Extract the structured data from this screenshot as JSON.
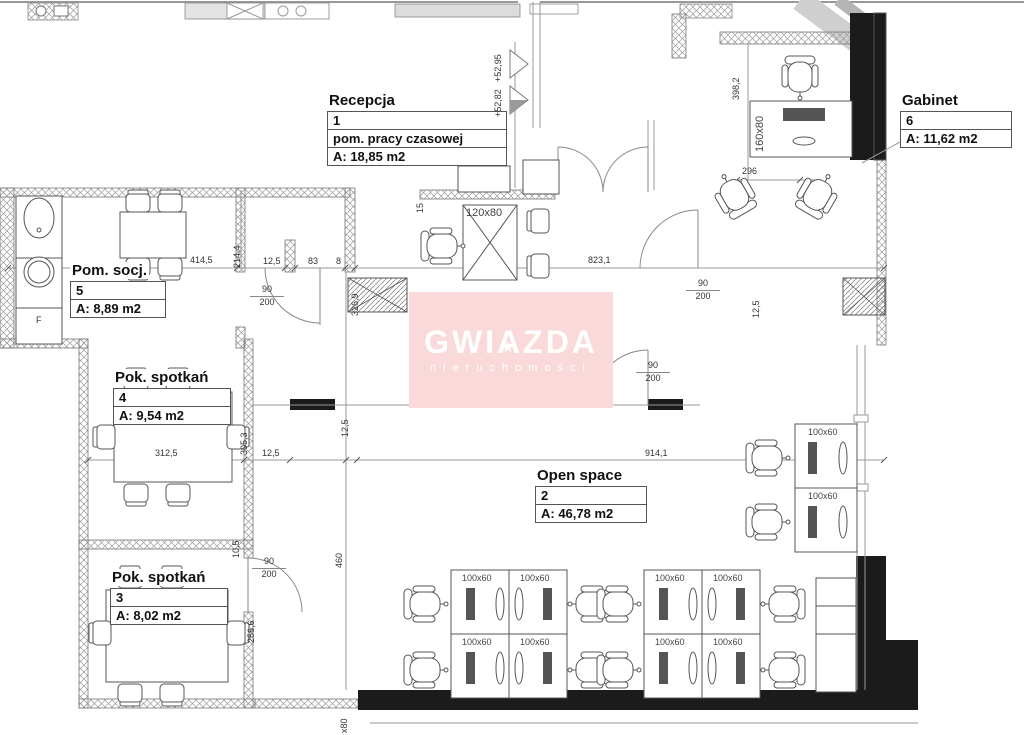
{
  "watermark": {
    "brand": "GWIAZDA",
    "subtitle": "nieruchomości",
    "star": "★",
    "bg_color": "#f9d9d9",
    "text_color": "#ffffff"
  },
  "rooms": {
    "recepcja": {
      "title": "Recepcja",
      "number": "1",
      "subtitle": "pom. pracy czasowej",
      "area": "A: 18,85 m2"
    },
    "open_space": {
      "title": "Open space",
      "number": "2",
      "area": "A: 46,78 m2"
    },
    "pok_spotkan_3": {
      "title": "Pok. spotkań",
      "number": "3",
      "area": "A: 8,02 m2"
    },
    "pok_spotkan_4": {
      "title": "Pok. spotkań",
      "number": "4",
      "area": "A: 9,54 m2"
    },
    "pom_socj": {
      "title": "Pom. socj.",
      "number": "5",
      "area": "A: 8,89 m2"
    },
    "gabinet": {
      "title": "Gabinet",
      "number": "6",
      "area": "A: 11,62 m2"
    }
  },
  "door_size": {
    "w": "90",
    "h": "200"
  },
  "levels": {
    "upper": "+52,95",
    "lower": "+52,82"
  },
  "labels": {
    "desk_reception": "120x80",
    "desk_gabinet": "160x80",
    "desk_open": "100x60",
    "edge_partial": "x80",
    "socj_fixture": "F"
  },
  "dimensions": {
    "a414_5": "414,5",
    "a214_4": "214,4",
    "a12_5": "12,5",
    "a83": "83",
    "a8": "8",
    "a823_1": "823,1",
    "a326_9": "326,9",
    "b312_5": "312,5",
    "b914_1": "914,1",
    "b305_3": "305,3",
    "b10_5": "10,5",
    "b460": "460",
    "b256_6": "256,6",
    "c398_2": "398,2",
    "c296": "296",
    "c15": "15"
  }
}
